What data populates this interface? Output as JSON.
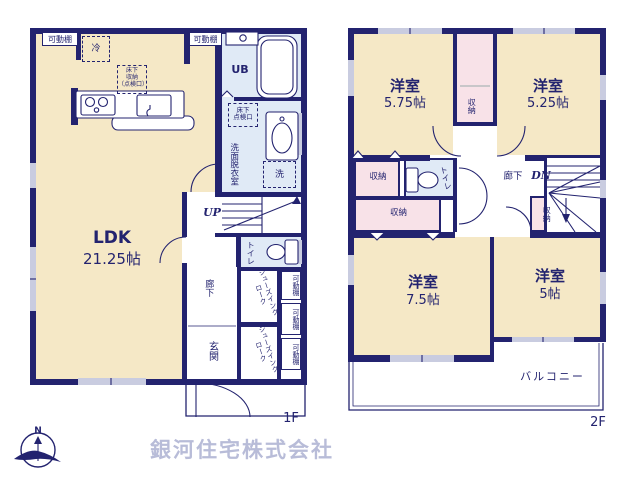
{
  "floor1": {
    "label": "1F",
    "ldk_name": "LDK",
    "ldk_size": "21.25帖",
    "fridge": "冷",
    "movable_shelf": "可動棚",
    "underfloor_storage": [
      "床下",
      "収納",
      "（点検口）"
    ],
    "unit_bath": "UB",
    "underfloor_hatch": [
      "床下",
      "点検口"
    ],
    "washroom": "洗面脱衣室",
    "washer": "洗",
    "stairs_up": "UP",
    "toilet": "トイレ",
    "hallway": "廊下",
    "entrance": "玄関",
    "shoe_closet": "シューズインクローク"
  },
  "floor2": {
    "label": "2F",
    "rooms": [
      {
        "name": "洋室",
        "size": "5.75帖"
      },
      {
        "name": "洋室",
        "size": "5.25帖"
      },
      {
        "name": "洋室",
        "size": "7.5帖"
      },
      {
        "name": "洋室",
        "size": "5帖"
      }
    ],
    "storage": "収納",
    "toilet": "トイレ",
    "hallway": "廊下",
    "stairs_down": "DN",
    "balcony": "バルコニー"
  },
  "footer": {
    "compass_north": "N",
    "company": "銀河住宅株式会社"
  },
  "colors": {
    "wall": "#23236f",
    "room_cream": "#f5e8c6",
    "wet_blue": "#e0eaf6",
    "storage_pink": "#f8e2e8",
    "window_gray": "#c9cce0",
    "company_text": "#b8bcd8"
  }
}
